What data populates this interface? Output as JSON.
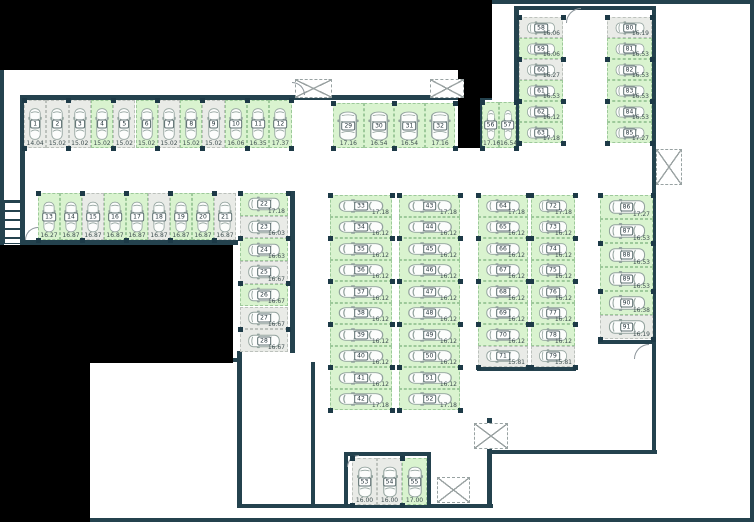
{
  "palette": {
    "wall": "#24424e",
    "outside": "#000000",
    "free_fill": "#d9f3cf",
    "free_border": "#9dc99a",
    "taken_fill": "#e9ebe7",
    "taken_border": "#bcc1bc",
    "badge_border": "#5d6f70",
    "text": "#3e4e50",
    "column": "#1d3a47",
    "car_stroke": "#93a39e"
  },
  "plan": {
    "walls": [
      [
        0,
        0,
        754,
        4
      ],
      [
        0,
        518,
        754,
        4
      ],
      [
        750,
        0,
        4,
        522
      ],
      [
        0,
        0,
        4,
        245
      ],
      [
        20,
        95,
        472,
        5
      ],
      [
        20,
        95,
        5,
        148
      ],
      [
        20,
        240,
        218,
        5
      ],
      [
        290,
        191,
        5,
        162
      ],
      [
        237,
        351,
        5,
        157
      ],
      [
        90,
        358,
        148,
        4
      ],
      [
        237,
        504,
        256,
        4
      ],
      [
        311,
        362,
        4,
        142
      ],
      [
        344,
        452,
        4,
        54
      ],
      [
        344,
        452,
        86,
        4
      ],
      [
        427,
        452,
        4,
        54
      ],
      [
        487,
        418,
        5,
        88
      ],
      [
        487,
        450,
        170,
        4
      ],
      [
        652,
        343,
        4,
        111
      ],
      [
        598,
        340,
        58,
        4
      ],
      [
        652,
        6,
        4,
        340
      ],
      [
        514,
        6,
        142,
        4
      ],
      [
        514,
        8,
        5,
        140
      ],
      [
        478,
        100,
        4,
        48
      ],
      [
        477,
        367,
        99,
        4
      ]
    ],
    "blackouts": [
      [
        0,
        0,
        492,
        70
      ],
      [
        458,
        70,
        22,
        78
      ],
      [
        480,
        70,
        12,
        28
      ],
      [
        0,
        245,
        233,
        118
      ],
      [
        0,
        362,
        90,
        160
      ]
    ],
    "shafts": [
      [
        295,
        79,
        37,
        19
      ],
      [
        430,
        79,
        34,
        19
      ],
      [
        474,
        423,
        34,
        26
      ],
      [
        656,
        149,
        26,
        36
      ],
      [
        437,
        477,
        33,
        26
      ]
    ],
    "doors": [
      {
        "x": 292,
        "y": 82,
        "s": 13,
        "c": "tr"
      },
      {
        "x": 566,
        "y": 8,
        "s": 15,
        "c": "tl"
      },
      {
        "x": 634,
        "y": 344,
        "s": 15,
        "c": "tl"
      },
      {
        "x": 347,
        "y": 455,
        "s": 12,
        "c": "tl"
      },
      {
        "x": 25,
        "y": 227,
        "s": 13,
        "c": "tl"
      }
    ],
    "stairs": {
      "x": 4,
      "y": 200,
      "w": 18,
      "h": 44
    },
    "groups": [
      {
        "id": "row-01-12",
        "orient": "v",
        "x": 24,
        "y": 100,
        "cw": 22.3,
        "ch": 48,
        "spaces": [
          {
            "n": "1",
            "a": "14.04",
            "s": "taken"
          },
          {
            "n": "2",
            "a": "15.02",
            "s": "taken"
          },
          {
            "n": "3",
            "a": "15.02",
            "s": "taken"
          },
          {
            "n": "4",
            "a": "15.02",
            "s": "free"
          },
          {
            "n": "5",
            "a": "15.02",
            "s": "taken"
          },
          {
            "n": "6",
            "a": "15.02",
            "s": "free"
          },
          {
            "n": "7",
            "a": "15.02",
            "s": "taken"
          },
          {
            "n": "8",
            "a": "15.02",
            "s": "free"
          },
          {
            "n": "9",
            "a": "15.02",
            "s": "taken"
          },
          {
            "n": "10",
            "a": "16.06",
            "s": "free"
          },
          {
            "n": "11",
            "a": "16.35",
            "s": "free"
          },
          {
            "n": "12",
            "a": "17.37",
            "s": "free"
          }
        ]
      },
      {
        "id": "row-13-21",
        "orient": "v",
        "x": 38,
        "y": 193,
        "cw": 22,
        "ch": 47,
        "spaces": [
          {
            "n": "13",
            "a": "16.27",
            "s": "free"
          },
          {
            "n": "14",
            "a": "16.87",
            "s": "free"
          },
          {
            "n": "15",
            "a": "16.87",
            "s": "taken"
          },
          {
            "n": "16",
            "a": "16.87",
            "s": "free"
          },
          {
            "n": "17",
            "a": "16.87",
            "s": "free"
          },
          {
            "n": "18",
            "a": "16.87",
            "s": "taken"
          },
          {
            "n": "19",
            "a": "16.87",
            "s": "free"
          },
          {
            "n": "20",
            "a": "16.87",
            "s": "free"
          },
          {
            "n": "21",
            "a": "16.87",
            "s": "taken"
          }
        ]
      },
      {
        "id": "col-22-28",
        "orient": "h",
        "x": 240,
        "y": 193,
        "cw": 48,
        "ch": 22.7,
        "spaces": [
          {
            "n": "22",
            "a": "17.18",
            "s": "free"
          },
          {
            "n": "23",
            "a": "16.03",
            "s": "taken"
          },
          {
            "n": "24",
            "a": "16.63",
            "s": "free"
          },
          {
            "n": "25",
            "a": "16.67",
            "s": "taken"
          },
          {
            "n": "26",
            "a": "16.67",
            "s": "free"
          },
          {
            "n": "27",
            "a": "16.67",
            "s": "taken"
          },
          {
            "n": "28",
            "a": "16.67",
            "s": "taken"
          }
        ]
      },
      {
        "id": "row-29-32",
        "orient": "v",
        "x": 333,
        "y": 103,
        "cw": 30.6,
        "ch": 45,
        "spaces": [
          {
            "n": "29",
            "a": "17.16",
            "s": "free"
          },
          {
            "n": "30",
            "a": "16.54",
            "s": "free"
          },
          {
            "n": "31",
            "a": "16.54",
            "s": "free"
          },
          {
            "n": "32",
            "a": "17.16",
            "s": "free"
          }
        ]
      },
      {
        "id": "col-33-42",
        "orient": "h",
        "x": 330,
        "y": 195,
        "cw": 62,
        "ch": 21.5,
        "spaces": [
          {
            "n": "33",
            "a": "17.18",
            "s": "free"
          },
          {
            "n": "34",
            "a": "16.12",
            "s": "free"
          },
          {
            "n": "35",
            "a": "16.12",
            "s": "free"
          },
          {
            "n": "36",
            "a": "16.12",
            "s": "free"
          },
          {
            "n": "37",
            "a": "16.12",
            "s": "free"
          },
          {
            "n": "38",
            "a": "16.12",
            "s": "free"
          },
          {
            "n": "39",
            "a": "16.12",
            "s": "free"
          },
          {
            "n": "40",
            "a": "16.12",
            "s": "free"
          },
          {
            "n": "41",
            "a": "16.12",
            "s": "free"
          },
          {
            "n": "42",
            "a": "17.18",
            "s": "free"
          }
        ]
      },
      {
        "id": "col-43-52",
        "orient": "h",
        "x": 399,
        "y": 195,
        "cw": 61,
        "ch": 21.5,
        "spaces": [
          {
            "n": "43",
            "a": "17.18",
            "s": "free"
          },
          {
            "n": "44",
            "a": "16.12",
            "s": "free"
          },
          {
            "n": "45",
            "a": "16.12",
            "s": "free"
          },
          {
            "n": "46",
            "a": "16.12",
            "s": "free"
          },
          {
            "n": "47",
            "a": "16.12",
            "s": "free"
          },
          {
            "n": "48",
            "a": "16.12",
            "s": "free"
          },
          {
            "n": "49",
            "a": "16.12",
            "s": "free"
          },
          {
            "n": "50",
            "a": "16.12",
            "s": "free"
          },
          {
            "n": "51",
            "a": "16.12",
            "s": "free"
          },
          {
            "n": "52",
            "a": "17.18",
            "s": "free"
          }
        ]
      },
      {
        "id": "row-53-55",
        "orient": "v",
        "x": 352,
        "y": 458,
        "cw": 25,
        "ch": 47,
        "spaces": [
          {
            "n": "53",
            "a": "16.00",
            "s": "taken"
          },
          {
            "n": "54",
            "a": "16.00",
            "s": "taken"
          },
          {
            "n": "55",
            "a": "17.00",
            "s": "free"
          }
        ]
      },
      {
        "id": "row-56-57",
        "orient": "v",
        "x": 482,
        "y": 102,
        "cw": 17,
        "ch": 46,
        "spaces": [
          {
            "n": "56",
            "a": "17.16",
            "s": "free"
          },
          {
            "n": "57",
            "a": "16.54",
            "s": "free"
          }
        ]
      },
      {
        "id": "col-58-63",
        "orient": "h",
        "x": 519,
        "y": 17,
        "cw": 44,
        "ch": 21,
        "spaces": [
          {
            "n": "58",
            "a": "16.06",
            "s": "taken"
          },
          {
            "n": "59",
            "a": "16.06",
            "s": "free"
          },
          {
            "n": "60",
            "a": "16.27",
            "s": "taken"
          },
          {
            "n": "61",
            "a": "16.53",
            "s": "free"
          },
          {
            "n": "62",
            "a": "16.12",
            "s": "free"
          },
          {
            "n": "63",
            "a": "17.18",
            "s": "free"
          }
        ]
      },
      {
        "id": "col-80-85",
        "orient": "h",
        "x": 607,
        "y": 17,
        "cw": 45,
        "ch": 21,
        "spaces": [
          {
            "n": "80",
            "a": "16.19",
            "s": "taken"
          },
          {
            "n": "81",
            "a": "16.53",
            "s": "free"
          },
          {
            "n": "82",
            "a": "16.53",
            "s": "free"
          },
          {
            "n": "83",
            "a": "16.53",
            "s": "free"
          },
          {
            "n": "84",
            "a": "16.53",
            "s": "free"
          },
          {
            "n": "85",
            "a": "17.27",
            "s": "free"
          }
        ]
      },
      {
        "id": "col-64-71",
        "orient": "h",
        "x": 478,
        "y": 195,
        "cw": 50,
        "ch": 21.5,
        "spaces": [
          {
            "n": "64",
            "a": "17.18",
            "s": "free"
          },
          {
            "n": "65",
            "a": "16.12",
            "s": "free"
          },
          {
            "n": "66",
            "a": "16.12",
            "s": "free"
          },
          {
            "n": "67",
            "a": "16.12",
            "s": "free"
          },
          {
            "n": "68",
            "a": "16.12",
            "s": "free"
          },
          {
            "n": "69",
            "a": "16.12",
            "s": "free"
          },
          {
            "n": "70",
            "a": "16.12",
            "s": "free"
          },
          {
            "n": "71",
            "a": "15.81",
            "s": "taken"
          }
        ]
      },
      {
        "id": "col-72-79",
        "orient": "h",
        "x": 531,
        "y": 195,
        "cw": 44,
        "ch": 21.5,
        "spaces": [
          {
            "n": "72",
            "a": "17.18",
            "s": "free"
          },
          {
            "n": "73",
            "a": "16.12",
            "s": "free"
          },
          {
            "n": "74",
            "a": "16.12",
            "s": "free"
          },
          {
            "n": "75",
            "a": "16.12",
            "s": "free"
          },
          {
            "n": "76",
            "a": "16.12",
            "s": "free"
          },
          {
            "n": "77",
            "a": "16.12",
            "s": "free"
          },
          {
            "n": "78",
            "a": "16.12",
            "s": "free"
          },
          {
            "n": "79",
            "a": "15.81",
            "s": "taken"
          }
        ]
      },
      {
        "id": "col-86-91",
        "orient": "h",
        "x": 600,
        "y": 195,
        "cw": 53,
        "ch": 24,
        "spaces": [
          {
            "n": "86",
            "a": "17.27",
            "s": "free"
          },
          {
            "n": "87",
            "a": "16.53",
            "s": "free"
          },
          {
            "n": "88",
            "a": "16.53",
            "s": "free"
          },
          {
            "n": "89",
            "a": "16.53",
            "s": "free"
          },
          {
            "n": "90",
            "a": "16.38",
            "s": "free"
          },
          {
            "n": "91",
            "a": "16.19",
            "s": "taken"
          }
        ]
      }
    ]
  }
}
